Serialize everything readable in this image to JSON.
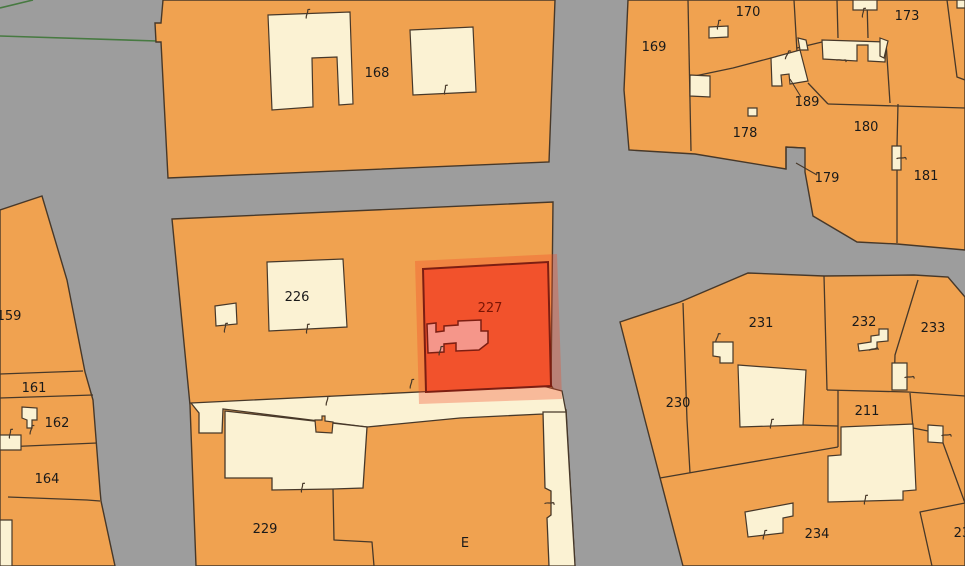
{
  "map": {
    "colors": {
      "background": "#9d9d9d",
      "parcel_fill": "#f0a250",
      "building_fill": "#fbf2d3",
      "outline": "#473829",
      "green_boundary": "#477a41",
      "label": "#1a1a1a",
      "selected_fill": "#f2522c",
      "selected_outline": "#7c1e12",
      "selected_building_fill": "#f5968a",
      "selected_halo": "rgba(242,72,38,0.33)",
      "selected_label": "#7a1505"
    },
    "selected_parcel_id": "227",
    "parcel_labels": [
      {
        "text": "168",
        "x": 377,
        "y": 77
      },
      {
        "text": "169",
        "x": 654,
        "y": 51
      },
      {
        "text": "170",
        "x": 748,
        "y": 16
      },
      {
        "text": "173",
        "x": 907,
        "y": 20
      },
      {
        "text": "178",
        "x": 745,
        "y": 137
      },
      {
        "text": "179",
        "x": 827,
        "y": 182
      },
      {
        "text": "180",
        "x": 866,
        "y": 131
      },
      {
        "text": "181",
        "x": 926,
        "y": 180
      },
      {
        "text": "189",
        "x": 807,
        "y": 106
      },
      {
        "text": "226",
        "x": 297,
        "y": 301
      },
      {
        "text": "227",
        "x": 490,
        "y": 312,
        "selected": true
      },
      {
        "text": "229",
        "x": 265,
        "y": 533
      },
      {
        "text": "230",
        "x": 678,
        "y": 407
      },
      {
        "text": "231",
        "x": 761,
        "y": 327
      },
      {
        "text": "232",
        "x": 864,
        "y": 326
      },
      {
        "text": "233",
        "x": 933,
        "y": 332
      },
      {
        "text": "211",
        "x": 867,
        "y": 415
      },
      {
        "text": "234",
        "x": 817,
        "y": 538
      },
      {
        "text": "235",
        "x": 966,
        "y": 537
      },
      {
        "text": "159",
        "x": 9,
        "y": 320
      },
      {
        "text": "161",
        "x": 34,
        "y": 392
      },
      {
        "text": "162",
        "x": 57,
        "y": 427
      },
      {
        "text": "164",
        "x": 47,
        "y": 483
      },
      {
        "text": "E",
        "x": 465,
        "y": 547
      }
    ]
  }
}
